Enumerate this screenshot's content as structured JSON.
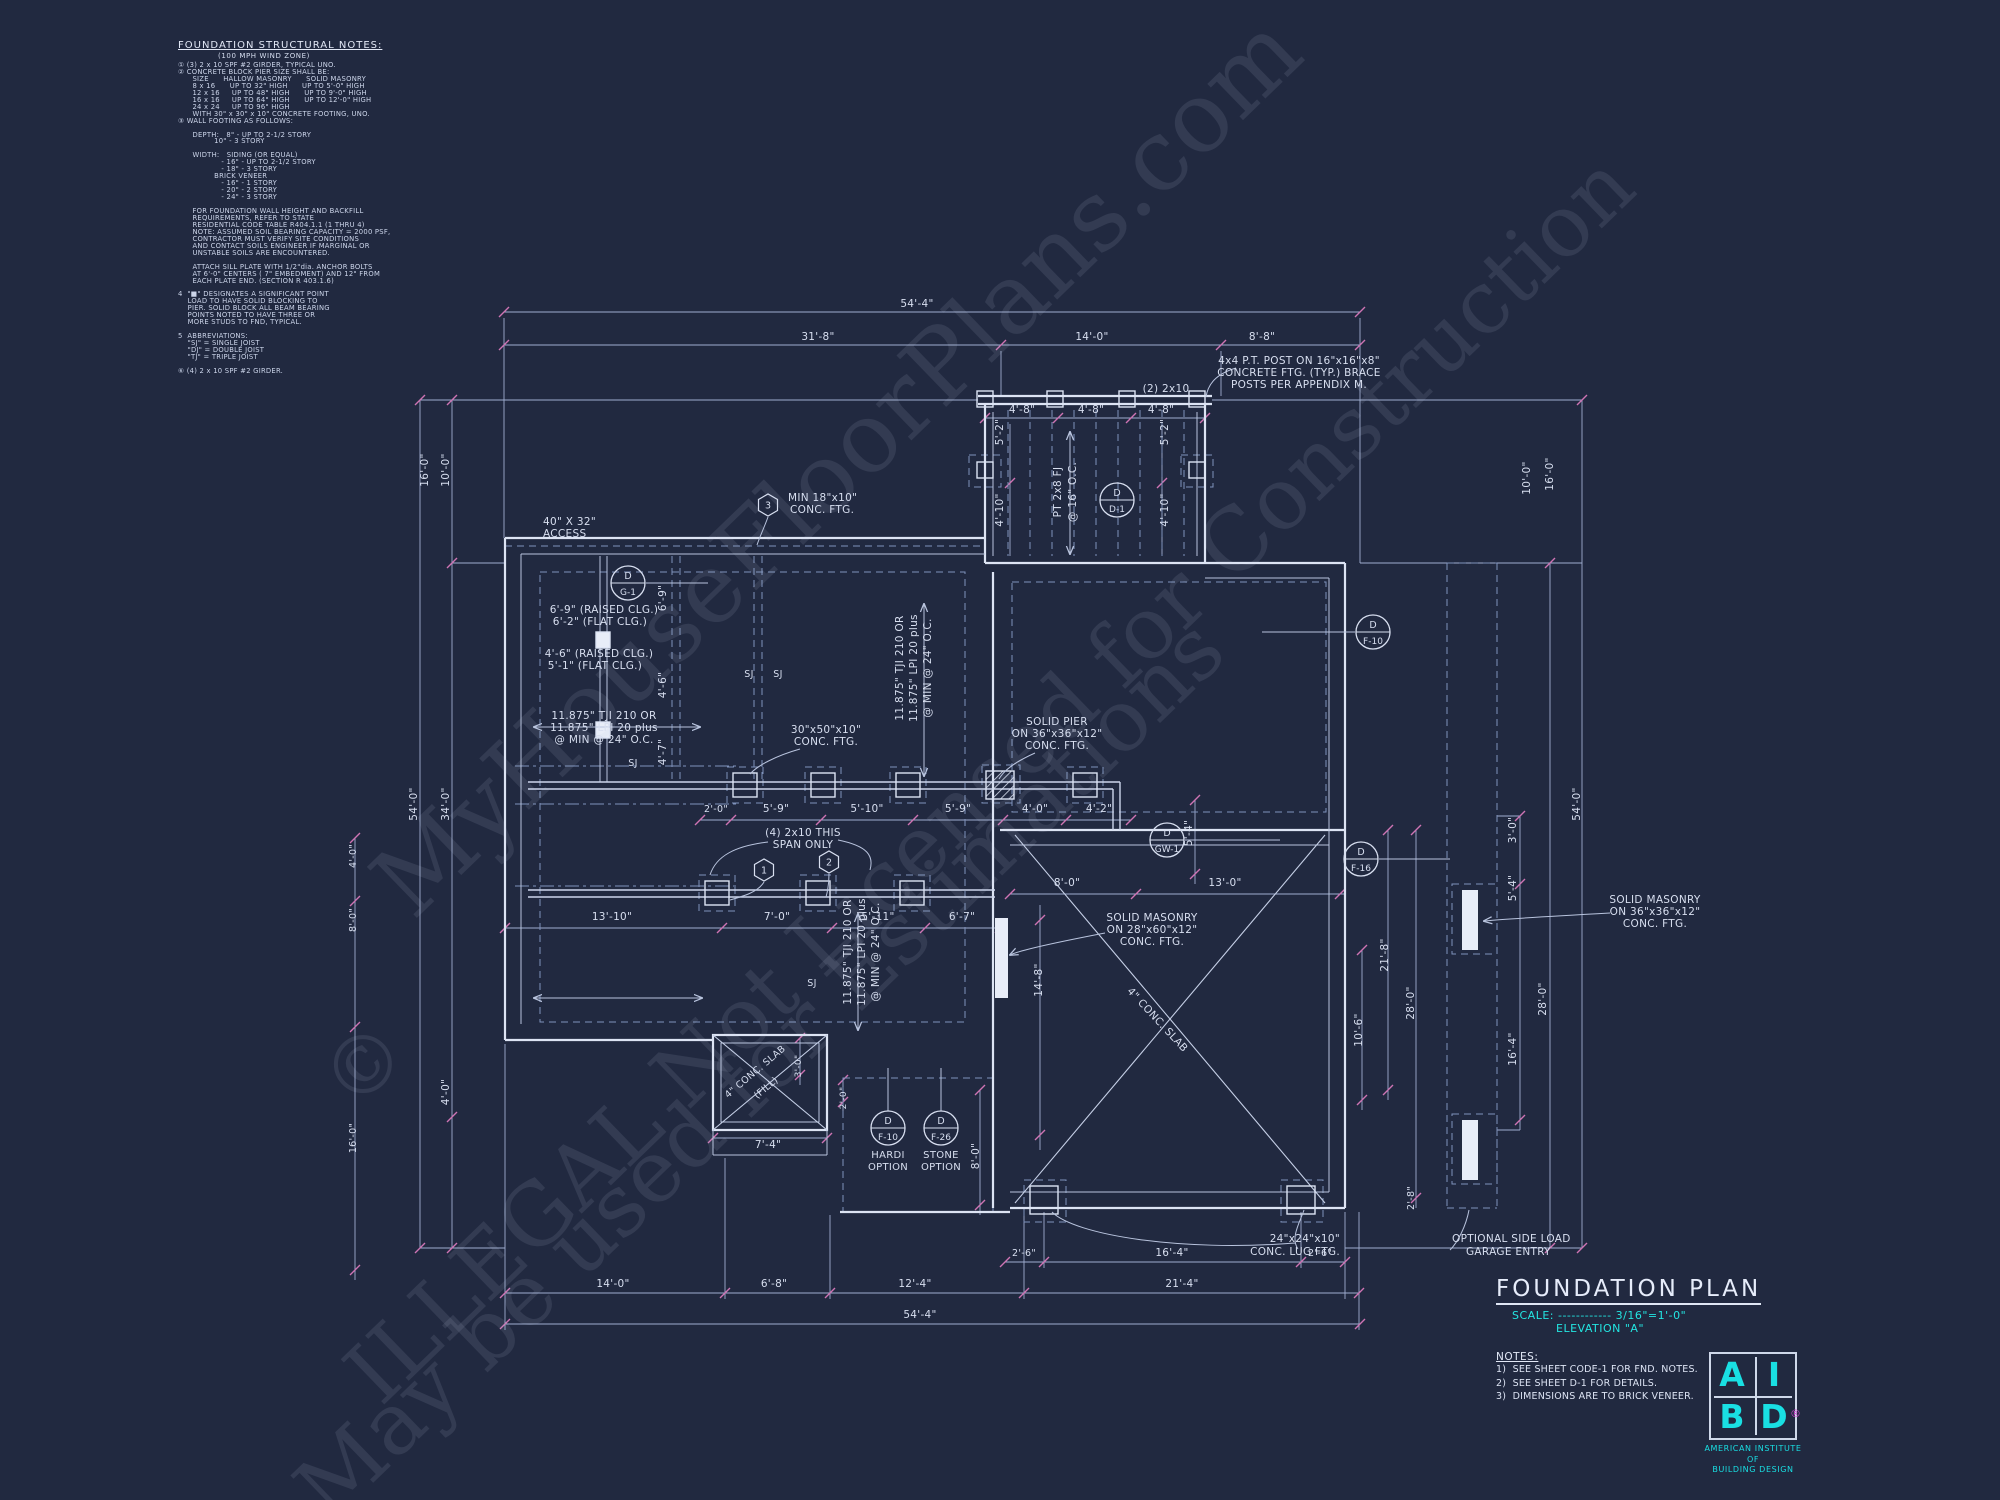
{
  "page": {
    "background": "#212940"
  },
  "colors": {
    "background": "#212940",
    "linework": "#dde4f4",
    "dim_lines": "#9fadd0",
    "tick_marks": "#cf74b4",
    "accent_cyan": "#23e5e1",
    "registered_magenta": "#d14ad1",
    "watermark": "#c3cde6"
  },
  "notes_block": {
    "title": "FOUNDATION STRUCTURAL NOTES:",
    "subtitle": "(100 MPH WIND ZONE)",
    "lines": [
      "① (3) 2 x 10 SPF #2 GIRDER, TYPICAL UNO.",
      "② CONCRETE BLOCK PIER SIZE SHALL BE:",
      "      SIZE      HALLOW MASONRY      SOLID MASONRY",
      "      8 x 16      UP TO 32\" HIGH      UP TO 5'-0\" HIGH",
      "      12 x 16     UP TO 48\" HIGH      UP TO 9'-0\" HIGH",
      "      16 x 16     UP TO 64\" HIGH      UP TO 12'-0\" HIGH",
      "      24 x 24     UP TO 96\" HIGH",
      "      WITH 30\" x 30\" x 10\" CONCRETE FOOTING, UNO.",
      "③ WALL FOOTING AS FOLLOWS:",
      "",
      "      DEPTH:   8\" - UP TO 2-1/2 STORY",
      "               10\" - 3 STORY",
      "",
      "      WIDTH:   SIDING (OR EQUAL)",
      "                  - 16\" - UP TO 2-1/2 STORY",
      "                  - 18\" - 3 STORY",
      "               BRICK VENEER",
      "                  - 16\" - 1 STORY",
      "                  - 20\" - 2 STORY",
      "                  - 24\" - 3 STORY",
      "",
      "      FOR FOUNDATION WALL HEIGHT AND BACKFILL",
      "      REQUIREMENTS, REFER TO STATE",
      "      RESIDENTIAL CODE TABLE R404.1.1 (1 THRU 4)",
      "      NOTE: ASSUMED SOIL BEARING CAPACITY = 2000 PSF,",
      "      CONTRACTOR MUST VERIFY SITE CONDITIONS",
      "      AND CONTACT SOILS ENGINEER IF MARGINAL OR",
      "      UNSTABLE SOILS ARE ENCOUNTERED.",
      "",
      "      ATTACH SILL PLATE WITH 1/2\"dia. ANCHOR BOLTS",
      "      AT 6'-0\" CENTERS ( 7\" EMBEDMENT) AND 12\" FROM",
      "      EACH PLATE END. (SECTION R 403.1.6)",
      "",
      "4  \"■\" DESIGNATES A SIGNIFICANT POINT",
      "    LOAD TO HAVE SOLID BLOCKING TO",
      "    PIER. SOLID BLOCK ALL BEAM BEARING",
      "    POINTS NOTED TO HAVE THREE OR",
      "    MORE STUDS TO FND, TYPICAL.",
      "",
      "5  ABBREVIATIONS:",
      "    \"SJ\" = SINGLE JOIST",
      "    \"DJ\" = DOUBLE JOIST",
      "    \"TJ\" = TRIPLE JOIST",
      "",
      "⑥ (4) 2 x 10 SPF #2 GIRDER."
    ]
  },
  "plan": {
    "labels": [
      {
        "t": "54'-4\"",
        "x": 917,
        "y": 307
      },
      {
        "t": "31'-8\"",
        "x": 818,
        "y": 340
      },
      {
        "t": "14'-0\"",
        "x": 1092,
        "y": 340
      },
      {
        "t": "8'-8\"",
        "x": 1262,
        "y": 340
      },
      {
        "t": "4'-8\"",
        "x": 1022,
        "y": 413
      },
      {
        "t": "4'-8\"",
        "x": 1091,
        "y": 413
      },
      {
        "t": "4'-8\"",
        "x": 1161,
        "y": 413
      },
      {
        "t": "(2) 2x10",
        "x": 1166,
        "y": 392
      },
      {
        "t": "4x4 P.T. POST ON 16\"x16\"x8\"",
        "x": 1299,
        "y": 364
      },
      {
        "t": "CONCRETE FTG. (TYP.) BRACE",
        "x": 1299,
        "y": 376
      },
      {
        "t": "POSTS PER APPENDIX M.",
        "x": 1299,
        "y": 388
      },
      {
        "t": "5'-2\"",
        "x": 1003,
        "y": 432,
        "r": -90
      },
      {
        "t": "5'-2\"",
        "x": 1168,
        "y": 432,
        "r": -90
      },
      {
        "t": "4'-10\"",
        "x": 1003,
        "y": 510,
        "r": -90
      },
      {
        "t": "4'-10\"",
        "x": 1168,
        "y": 510,
        "r": -90
      },
      {
        "t": "PT 2x8 FJ",
        "x": 1061,
        "y": 492,
        "r": -90
      },
      {
        "t": "@ 16\" O.C.",
        "x": 1076,
        "y": 492,
        "r": -90
      },
      {
        "t": "MIN 18\"x10\"",
        "x": 788,
        "y": 501,
        "a": "start"
      },
      {
        "t": "CONC. FTG.",
        "x": 790,
        "y": 513,
        "a": "start"
      },
      {
        "t": "40\" X 32\"",
        "x": 543,
        "y": 525,
        "a": "start"
      },
      {
        "t": "ACCESS",
        "x": 543,
        "y": 537,
        "a": "start"
      },
      {
        "t": "6'-9\" (RAISED CLG.)",
        "x": 604,
        "y": 613
      },
      {
        "t": "6'-2\" (FLAT CLG.)",
        "x": 600,
        "y": 625
      },
      {
        "t": "4'-6\" (RAISED CLG.)",
        "x": 599,
        "y": 657
      },
      {
        "t": "5'-1\" (FLAT CLG.)",
        "x": 595,
        "y": 669
      },
      {
        "t": "6'-9\"",
        "x": 666,
        "y": 598,
        "r": -90
      },
      {
        "t": "4'-6\"",
        "x": 666,
        "y": 685,
        "r": -90
      },
      {
        "t": "4'-7\"",
        "x": 666,
        "y": 752,
        "r": -90
      },
      {
        "t": "11.875\" TJI 210 OR",
        "x": 604,
        "y": 719
      },
      {
        "t": "11.875\" LPI 20 plus",
        "x": 604,
        "y": 731
      },
      {
        "t": "@ MIN @ 24\" O.C.",
        "x": 604,
        "y": 743
      },
      {
        "t": "SJ",
        "x": 749,
        "y": 677,
        "s": 9.5
      },
      {
        "t": "SJ",
        "x": 778,
        "y": 677,
        "s": 9.5
      },
      {
        "t": "SJ",
        "x": 633,
        "y": 766,
        "s": 9.5
      },
      {
        "t": "SJ",
        "x": 812,
        "y": 986,
        "s": 9.5
      },
      {
        "t": "11.875\" TJI 210 OR",
        "x": 903,
        "y": 668,
        "r": -90
      },
      {
        "t": "11.875\" LPI 20 plus",
        "x": 917,
        "y": 668,
        "r": -90
      },
      {
        "t": "@ MIN @ 24\" O.C.",
        "x": 931,
        "y": 668,
        "r": -90
      },
      {
        "t": "30\"x50\"x10\"",
        "x": 826,
        "y": 733
      },
      {
        "t": "CONC. FTG.",
        "x": 826,
        "y": 745
      },
      {
        "t": "SOLID PIER",
        "x": 1057,
        "y": 725
      },
      {
        "t": "ON 36\"x36\"x12\"",
        "x": 1057,
        "y": 737
      },
      {
        "t": "CONC. FTG.",
        "x": 1057,
        "y": 749
      },
      {
        "t": "2'-0\"",
        "x": 716,
        "y": 812,
        "s": 9.5
      },
      {
        "t": "5'-9\"",
        "x": 776,
        "y": 812
      },
      {
        "t": "5'-10\"",
        "x": 867,
        "y": 812
      },
      {
        "t": "5'-9\"",
        "x": 958,
        "y": 812
      },
      {
        "t": "4'-0\"",
        "x": 1035,
        "y": 812
      },
      {
        "t": "4'-2\"",
        "x": 1099,
        "y": 812
      },
      {
        "t": "(4) 2x10 THIS",
        "x": 803,
        "y": 836
      },
      {
        "t": "SPAN ONLY",
        "x": 803,
        "y": 848
      },
      {
        "t": "11.875\" TJI 210 OR",
        "x": 851,
        "y": 952,
        "r": -90
      },
      {
        "t": "11.875\" LPI 20 plus",
        "x": 865,
        "y": 952,
        "r": -90
      },
      {
        "t": "@ MIN @ 24\" O.C.",
        "x": 879,
        "y": 952,
        "r": -90
      },
      {
        "t": "13'-10\"",
        "x": 612,
        "y": 920
      },
      {
        "t": "7'-0\"",
        "x": 777,
        "y": 920
      },
      {
        "t": "5'-11\"",
        "x": 878,
        "y": 920
      },
      {
        "t": "6'-7\"",
        "x": 962,
        "y": 920
      },
      {
        "t": "8'-0\"",
        "x": 1067,
        "y": 886
      },
      {
        "t": "13'-0\"",
        "x": 1225,
        "y": 886
      },
      {
        "t": "SOLID MASONRY",
        "x": 1152,
        "y": 921
      },
      {
        "t": "ON 28\"x60\"x12\"",
        "x": 1152,
        "y": 933
      },
      {
        "t": "CONC. FTG.",
        "x": 1152,
        "y": 945
      },
      {
        "t": "14'-8\"",
        "x": 1042,
        "y": 980,
        "r": -90
      },
      {
        "t": "5'-4\"",
        "x": 1192,
        "y": 833,
        "r": -90
      },
      {
        "t": "4\" CONC. SLAB",
        "x": 1155,
        "y": 1022,
        "r": 47
      },
      {
        "t": "4\" CONC. SLAB",
        "x": 757,
        "y": 1074,
        "r": -40,
        "s": 9.5
      },
      {
        "t": "(FILL)",
        "x": 768,
        "y": 1090,
        "r": -40,
        "s": 9.5
      },
      {
        "t": "3'-0\"",
        "x": 801,
        "y": 1066,
        "r": -90,
        "s": 9
      },
      {
        "t": "2'-0\"",
        "x": 846,
        "y": 1098,
        "r": -90,
        "s": 9
      },
      {
        "t": "7'-4\"",
        "x": 768,
        "y": 1148
      },
      {
        "t": "HARDI",
        "x": 888,
        "y": 1158,
        "s": 10
      },
      {
        "t": "OPTION",
        "x": 888,
        "y": 1170,
        "s": 10
      },
      {
        "t": "STONE",
        "x": 941,
        "y": 1158,
        "s": 10
      },
      {
        "t": "OPTION",
        "x": 941,
        "y": 1170,
        "s": 10
      },
      {
        "t": "8'-0\"",
        "x": 979,
        "y": 1156,
        "r": -90
      },
      {
        "t": "24\"x24\"x10\"",
        "x": 1340,
        "y": 1242,
        "a": "end"
      },
      {
        "t": "CONC. LUG FTG.",
        "x": 1340,
        "y": 1255,
        "a": "end"
      },
      {
        "t": "OPTIONAL SIDE LOAD",
        "x": 1452,
        "y": 1242,
        "a": "start"
      },
      {
        "t": "GARAGE ENTRY",
        "x": 1466,
        "y": 1255,
        "a": "start"
      },
      {
        "t": "2'-6\"",
        "x": 1024,
        "y": 1256,
        "s": 9.5
      },
      {
        "t": "16'-4\"",
        "x": 1172,
        "y": 1256
      },
      {
        "t": "2'-6\"",
        "x": 1320,
        "y": 1256,
        "s": 9.5
      },
      {
        "t": "14'-0\"",
        "x": 613,
        "y": 1287
      },
      {
        "t": "6'-8\"",
        "x": 774,
        "y": 1287
      },
      {
        "t": "12'-4\"",
        "x": 915,
        "y": 1287
      },
      {
        "t": "21'-4\"",
        "x": 1182,
        "y": 1287
      },
      {
        "t": "54'-4\"",
        "x": 920,
        "y": 1318
      },
      {
        "t": "2'-8\"",
        "x": 1414,
        "y": 1198,
        "r": -90,
        "s": 9.5
      },
      {
        "t": "21'-8\"",
        "x": 1388,
        "y": 955,
        "r": -90
      },
      {
        "t": "10'-6\"",
        "x": 1362,
        "y": 1030,
        "r": -90
      },
      {
        "t": "28'-0\"",
        "x": 1414,
        "y": 1003,
        "r": -90
      },
      {
        "t": "28'-0\"",
        "x": 1546,
        "y": 999,
        "r": -90
      },
      {
        "t": "16'-4\"",
        "x": 1516,
        "y": 1049,
        "r": -90
      },
      {
        "t": "5'-4\"",
        "x": 1516,
        "y": 888,
        "r": -90
      },
      {
        "t": "3'-0\"",
        "x": 1516,
        "y": 830,
        "r": -90
      },
      {
        "t": "SOLID MASONRY",
        "x": 1655,
        "y": 903
      },
      {
        "t": "ON 36\"x36\"x12\"",
        "x": 1655,
        "y": 915
      },
      {
        "t": "CONC. FTG.",
        "x": 1655,
        "y": 927
      },
      {
        "t": "54'-0\"",
        "x": 417,
        "y": 804,
        "r": -90
      },
      {
        "t": "34'-0\"",
        "x": 449,
        "y": 804,
        "r": -90
      },
      {
        "t": "10'-0\"",
        "x": 449,
        "y": 470,
        "r": -90
      },
      {
        "t": "16'-0\"",
        "x": 428,
        "y": 470,
        "r": -90
      },
      {
        "t": "4'-0\"",
        "x": 449,
        "y": 1092,
        "r": -90
      },
      {
        "t": "4'-0\"",
        "x": 356,
        "y": 856,
        "r": -90,
        "s": 9.5
      },
      {
        "t": "8'-0\"",
        "x": 356,
        "y": 920,
        "r": -90,
        "s": 9.5
      },
      {
        "t": "16'-0\"",
        "x": 356,
        "y": 1138,
        "r": -90,
        "s": 9.5
      },
      {
        "t": "54'-0\"",
        "x": 1580,
        "y": 804,
        "r": -90
      },
      {
        "t": "10'-0\"",
        "x": 1530,
        "y": 478,
        "r": -90
      },
      {
        "t": "16'-0\"",
        "x": 1553,
        "y": 474,
        "r": -90
      }
    ],
    "detail_circles": [
      {
        "x": 628,
        "y": 583,
        "top": "D",
        "bottom": "G-1"
      },
      {
        "x": 1117,
        "y": 500,
        "top": "D",
        "bottom": "D-1"
      },
      {
        "x": 1373,
        "y": 632,
        "top": "D",
        "bottom": "F-10"
      },
      {
        "x": 1167,
        "y": 840,
        "top": "D",
        "bottom": "GW-1"
      },
      {
        "x": 1361,
        "y": 859,
        "top": "D",
        "bottom": "F-16"
      },
      {
        "x": 888,
        "y": 1128,
        "top": "D",
        "bottom": "F-10"
      },
      {
        "x": 941,
        "y": 1128,
        "top": "D",
        "bottom": "F-26"
      }
    ],
    "hex_markers": [
      {
        "x": 768,
        "y": 505,
        "t": "3"
      },
      {
        "x": 764,
        "y": 870,
        "t": "1"
      },
      {
        "x": 829,
        "y": 862,
        "t": "2"
      }
    ]
  },
  "watermarks": [
    {
      "text": "MyHouseFloorPlans.com",
      "x": 860,
      "y": 490,
      "rot": -44,
      "size": 98
    },
    {
      "text": "ILLEGAL  Not Licensed for Construction",
      "x": 1010,
      "y": 800,
      "rot": -44,
      "size": 86
    },
    {
      "text": "May be used for Estimations",
      "x": 780,
      "y": 1090,
      "rot": -44,
      "size": 86
    },
    {
      "text": "©",
      "x": 383,
      "y": 1085,
      "rot": -44,
      "size": 80
    }
  ],
  "title_block": {
    "title": "FOUNDATION PLAN",
    "scale_label": "SCALE:",
    "scale_dots": "------------",
    "scale_value": "3/16\"=1'-0\"",
    "elevation": "ELEVATION \"A\"",
    "notes_title": "NOTES:",
    "notes": [
      "1)  SEE SHEET CODE-1 FOR FND. NOTES.",
      "2)  SEE SHEET D-1 FOR DETAILS.",
      "3)  DIMENSIONS ARE TO BRICK VENEER."
    ],
    "logo": {
      "letters": [
        "A",
        "I",
        "B",
        "D"
      ],
      "registered": "®",
      "org": [
        "AMERICAN INSTITUTE",
        "OF",
        "BUILDING DESIGN"
      ]
    }
  }
}
